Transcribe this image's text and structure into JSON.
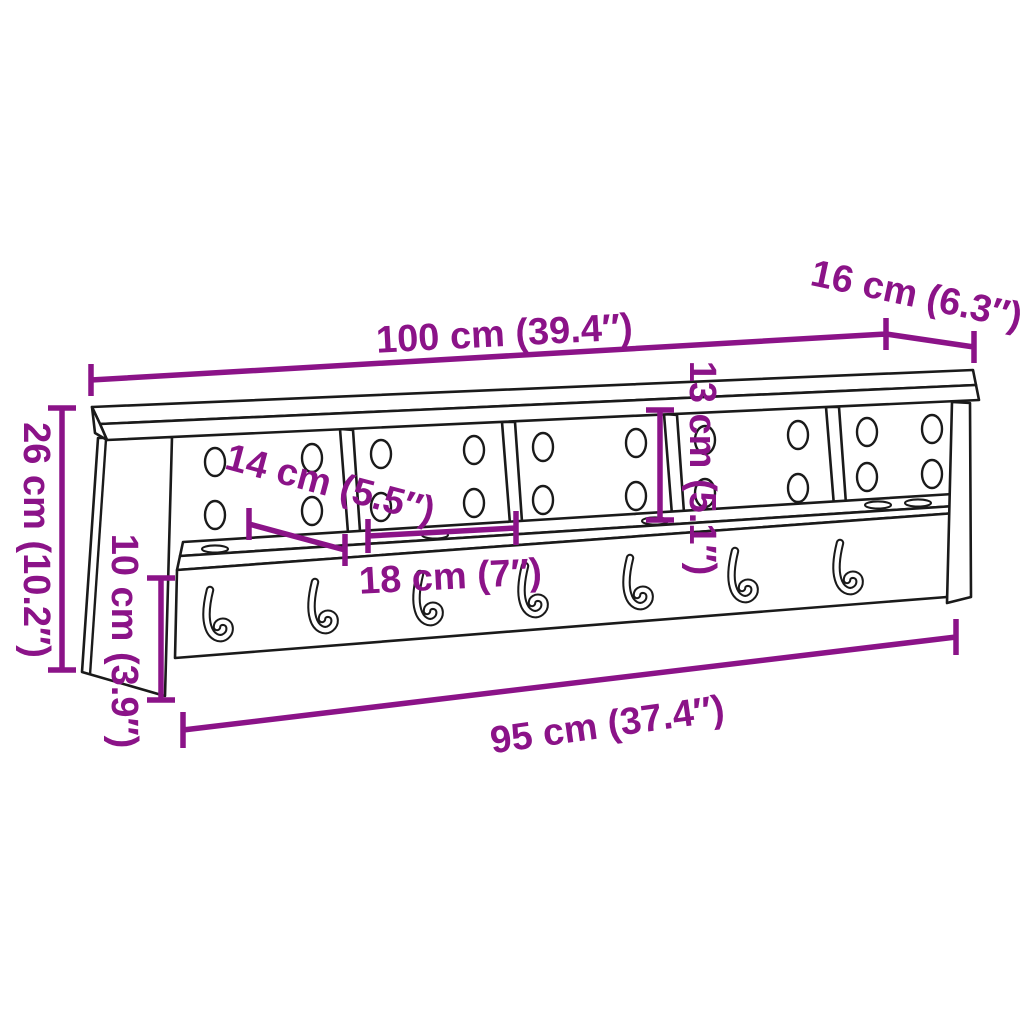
{
  "diagram": {
    "background_color": "#ffffff",
    "outline_color": "#1a1a1a",
    "dimension_color": "#8B1388",
    "dimensions": {
      "overall_width": "100 cm (39.4″)",
      "top_depth": "16 cm (6.3″)",
      "overall_height": "26 cm (10.2″)",
      "compartment_depth": "14 cm (5.5″)",
      "compartment_height": "13 cm (5.1″)",
      "compartment_width": "18 cm (7″)",
      "rail_height": "10 cm (3.9″)",
      "inner_width": "95 cm (37.4″)"
    },
    "features": {
      "compartments": 5,
      "hooks": 7
    }
  }
}
